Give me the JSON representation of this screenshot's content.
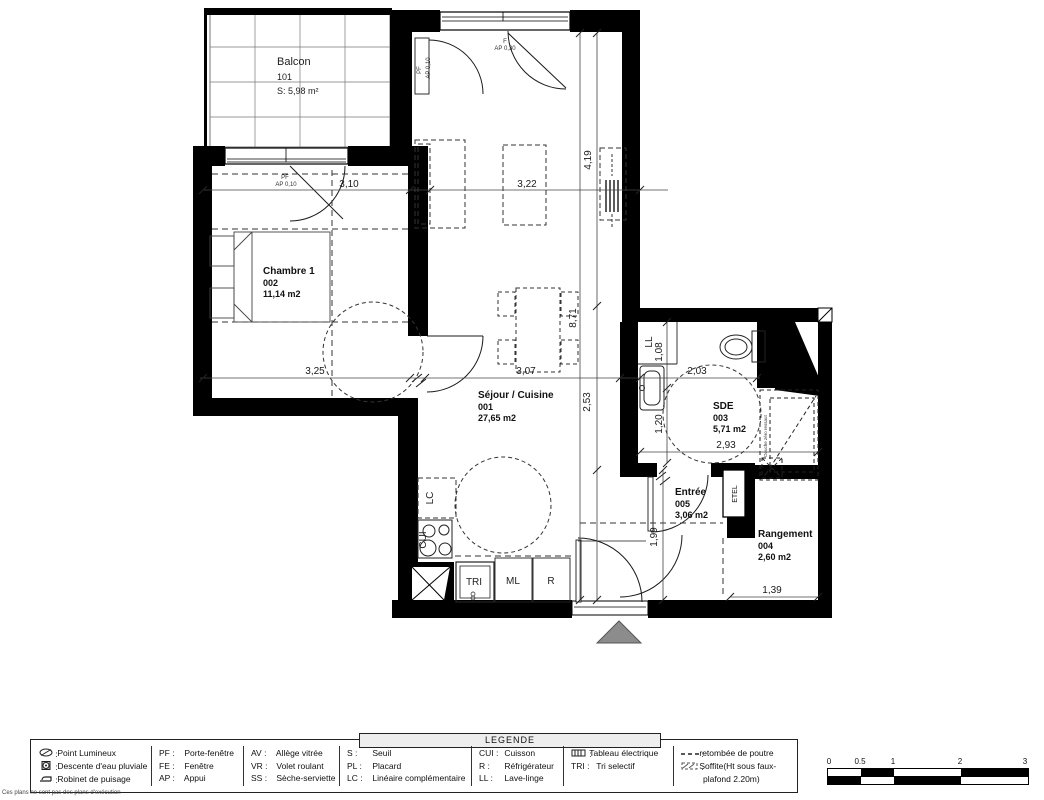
{
  "plan": {
    "rooms": {
      "balcon": {
        "name": "Balcon",
        "num": "101",
        "area": "S: 5,98 m²"
      },
      "chambre": {
        "name": "Chambre 1",
        "num": "002",
        "area": "11,14 m2"
      },
      "sejour": {
        "name": "Séjour / Cuisine",
        "num": "001",
        "area": "27,65 m2"
      },
      "sde": {
        "name": "SDE",
        "num": "003",
        "area": "5,71 m2"
      },
      "entree": {
        "name": "Entrée",
        "num": "005",
        "area": "3,06 m2"
      },
      "rangement": {
        "name": "Rangement",
        "num": "004",
        "area": "2,60 m2"
      }
    },
    "dims": {
      "chambre_w": "3,10",
      "sejour_w": "3,22",
      "right_upper": "4,19",
      "right_total": "8,71",
      "right_lower": "2,53",
      "chambre_w2": "3,25",
      "sejour_w2": "3,07",
      "sde_part": "2,03",
      "ll_h": "1,08",
      "sde_h": "1,20",
      "sde_w": "2,93",
      "entree_h": "1,99",
      "rangement_w": "1,39"
    },
    "openings": {
      "pf_sejour": "PF",
      "pf_sejour_ap": "AP 0,10",
      "f_sejour": "F",
      "f_sejour_ap": "AP 0,30",
      "pf_chambre": "PF",
      "pf_chambre_ap": "AP 0,10"
    },
    "equip": {
      "lc": "LC",
      "cui": "CUI",
      "tri": "TRI",
      "ml": "ML",
      "r": "R",
      "ll": "LL",
      "etel": "ETEL",
      "douche": "Douche zéro ressaut"
    }
  },
  "legend": {
    "title": "LEGENDE",
    "col1": [
      {
        "icon": "point-lumineux-icon",
        "label": "Point Lumineux"
      },
      {
        "icon": "descente-eau-icon",
        "label": "Descente d'eau pluviale"
      },
      {
        "icon": "robinet-puisage-icon",
        "label": "Robinet de puisage"
      }
    ],
    "col2": [
      {
        "abbr": "PF",
        "label": "Porte-fenêtre"
      },
      {
        "abbr": "FE",
        "label": "Fenêtre"
      },
      {
        "abbr": "AP",
        "label": "Appui"
      }
    ],
    "col3": [
      {
        "abbr": "AV",
        "label": "Allège vitrée"
      },
      {
        "abbr": "VR",
        "label": "Volet roulant"
      },
      {
        "abbr": "SS",
        "label": "Sèche-serviette"
      }
    ],
    "col4": [
      {
        "abbr": "S",
        "label": "Seuil"
      },
      {
        "abbr": "PL",
        "label": "Placard"
      },
      {
        "abbr": "LC",
        "label": "Linéaire complémentaire"
      }
    ],
    "col5": [
      {
        "abbr": "CUI",
        "label": "Cuisson"
      },
      {
        "abbr": "R",
        "label": "Réfrigérateur"
      },
      {
        "abbr": "LL",
        "label": "Lave-linge"
      }
    ],
    "col6": [
      {
        "icon": "tableau-electrique-icon",
        "label": "Tableau électrique"
      },
      {
        "abbr": "TRI",
        "label": "Tri selectif"
      }
    ],
    "col7": [
      {
        "icon": "retombee-poutre-icon",
        "label": "retombée de poutre"
      },
      {
        "icon": "soffite-icon",
        "label": "Soffite(Ht sous faux-"
      },
      {
        "label2": "plafond 2.20m)"
      }
    ]
  },
  "scalebar": {
    "labels": [
      "0",
      "0.5",
      "1",
      "2",
      "3"
    ]
  },
  "footnote": "Ces plans ne sont pas des plans d'exécution",
  "colors": {
    "wall": "#000000",
    "entrance_marker": "#8c8c8c"
  }
}
